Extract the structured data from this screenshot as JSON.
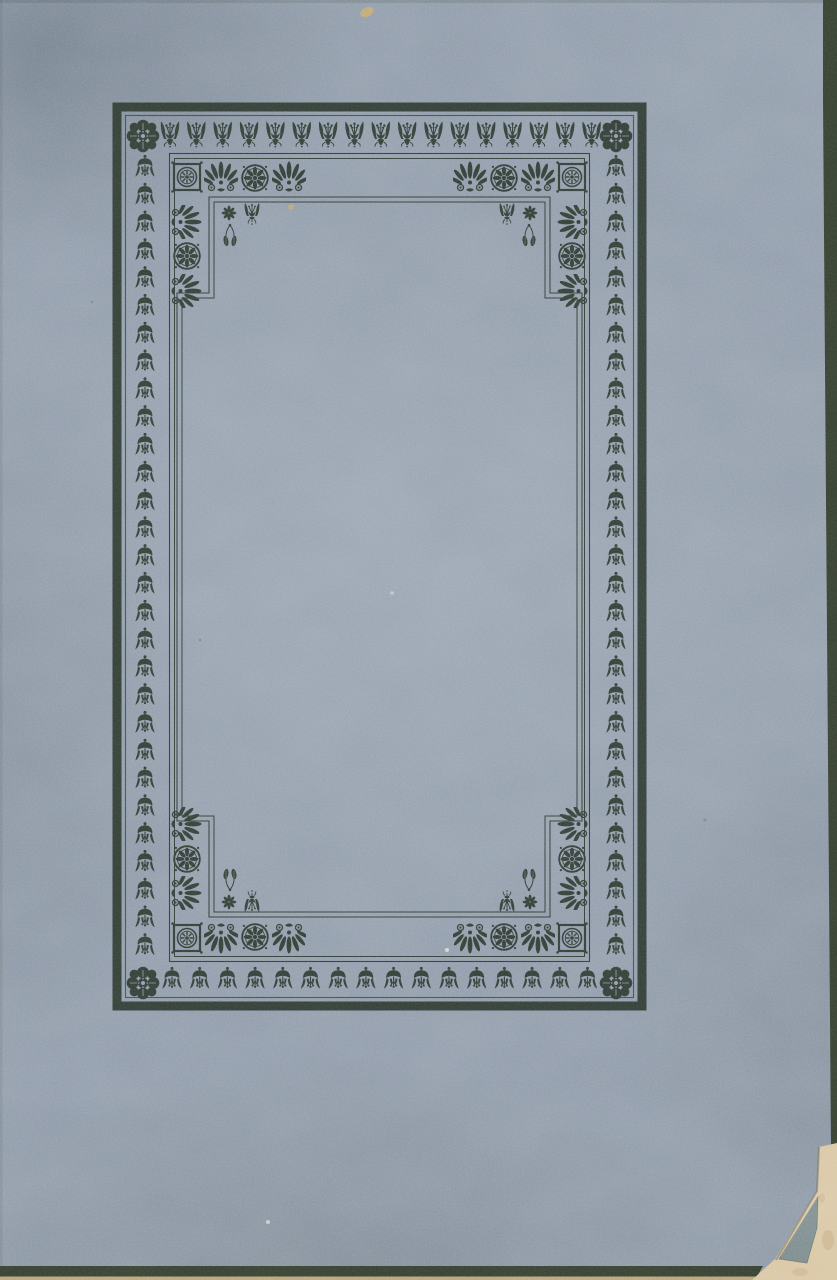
{
  "page": {
    "kind": "scanned book cover",
    "description": "Blue-gray paper book cover with a dark printed ornamental border frame, no lettering; dog-eared bottom-right corner showing cream pages beneath."
  },
  "colors": {
    "paper": "#8f9aa8",
    "paper_light": "#9fabb9",
    "paper_dark": "#6f7b88",
    "ink": "#2c342b",
    "edge_dark": "#343d2d",
    "deckle_tan": "#c3ad80",
    "under_page_cream": "#d9c6a2",
    "fold_flap_blue": "#7b8a8b",
    "fleck_tan": "#c2a96a"
  },
  "ornaments": {
    "top_band_motif": "upright-tulip",
    "side_band_motif": "hanging-bellflower",
    "bottom_band_motif": "hanging-bellflower",
    "band_corner_motif": "rosette-flower",
    "inner_corner_chain": [
      "square-rosette-medallion",
      "anthemion-palmette",
      "circle-rosette-medallion",
      "anthemion-palmette"
    ],
    "corner_sprigs": [
      "small-rosette",
      "tulip-bud",
      "hanging-buds"
    ],
    "top_band_count": 17,
    "bottom_band_count": 16,
    "left_band_count": 29,
    "right_band_count": 29
  }
}
